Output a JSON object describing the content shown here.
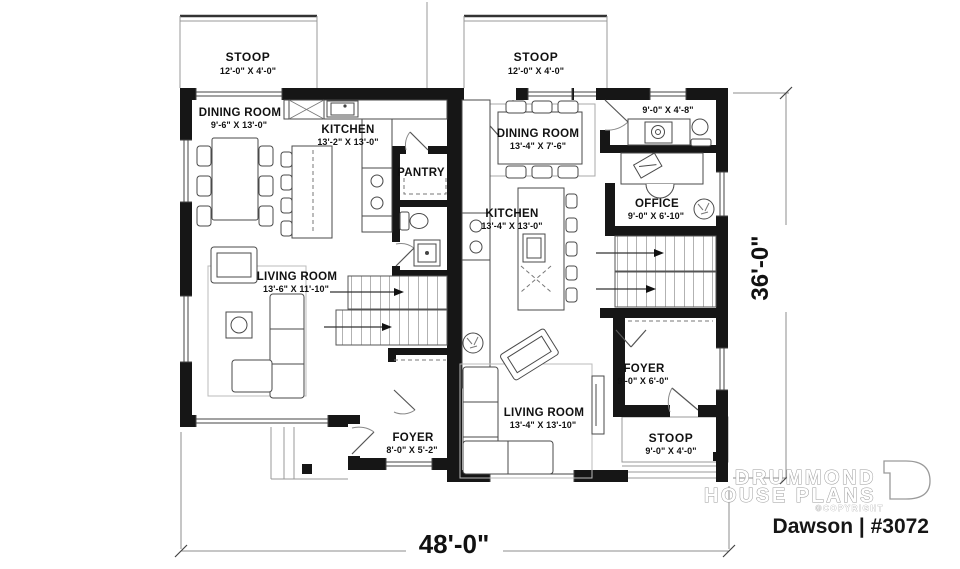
{
  "plan": {
    "name_label": "Dawson | #3072"
  },
  "brand": {
    "line1": "DRUMMOND",
    "line2": "HOUSE PLANS",
    "copyright": "©COPYRIGHT"
  },
  "dims": {
    "width": "48'-0\"",
    "height": "36'-0\""
  },
  "stoop_top_left": {
    "name": "STOOP",
    "size": "12'-0\" X 4'-0\""
  },
  "stoop_top_right": {
    "name": "STOOP",
    "size": "12'-0\" X 4'-0\""
  },
  "stoop_bottom_right": {
    "name": "STOOP",
    "size": "9'-0\" X 4'-0\""
  },
  "left_unit": {
    "dining": {
      "name": "DINING ROOM",
      "size": "9'-6\" X 13'-0\""
    },
    "kitchen": {
      "name": "KITCHEN",
      "size": "13'-2\" X 13'-0\""
    },
    "pantry": {
      "name": "PANTRY"
    },
    "living": {
      "name": "LIVING ROOM",
      "size": "13'-6\" X 11'-10\""
    },
    "foyer": {
      "name": "FOYER",
      "size": "8'-0\" X 5'-2\""
    }
  },
  "right_unit": {
    "dining": {
      "name": "DINING ROOM",
      "size": "13'-4\" X 7'-6\""
    },
    "utility": {
      "size": "9'-0\" X 4'-8\""
    },
    "office": {
      "name": "OFFICE",
      "size": "9'-0\" X 6'-10\""
    },
    "kitchen": {
      "name": "KITCHEN",
      "size": "13'-4\" X 13'-0\""
    },
    "foyer": {
      "name": "FOYER",
      "size": "9'-0\" X 6'-0\""
    },
    "living": {
      "name": "LIVING ROOM",
      "size": "13'-4\" X 13'-10\""
    }
  }
}
